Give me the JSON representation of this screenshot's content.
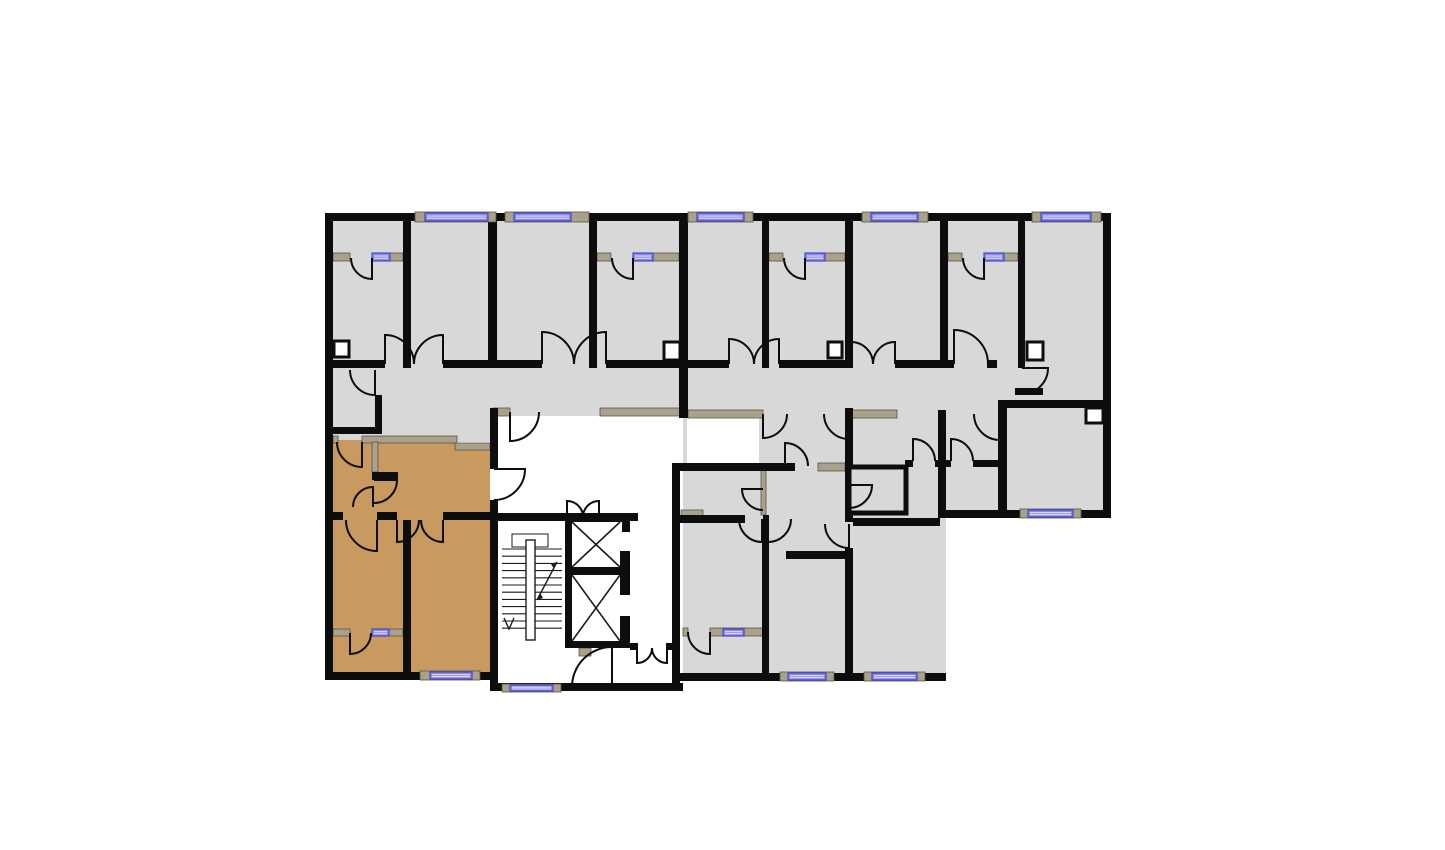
{
  "meta": {
    "type": "floor-plan",
    "canvas": {
      "w": 1445,
      "h": 850
    }
  },
  "palette": {
    "background": "#ffffff",
    "room_gray": "#d8d8d8",
    "highlight_tan": "#c89a60",
    "wall_black": "#0d0d0d",
    "partition_khaki": "#a9a18a",
    "partition_edge": "#57544a",
    "window_blue": "#8a88ee",
    "window_border": "#4547c9",
    "window_stripe": "#d9d9fb",
    "thin_line": "#1c1c1c"
  },
  "floorplan": {
    "gray_fills": [
      [
        333,
        221,
        770,
        147
      ],
      [
        1025,
        360,
        78,
        48
      ],
      [
        333,
        360,
        347,
        56
      ],
      [
        687,
        360,
        253,
        58
      ],
      [
        938,
        368,
        165,
        150
      ],
      [
        333,
        408,
        164,
        34
      ],
      [
        683,
        416,
        263,
        260
      ]
    ],
    "white_patches": [
      [
        687,
        418,
        72,
        45
      ]
    ],
    "highlight_polygon": "333,440 455,440 455,448 490,448 490,672 333,672",
    "khaki_walls": [
      [
        333,
        253,
        17,
        8
      ],
      [
        390,
        253,
        13,
        8
      ],
      [
        597,
        253,
        14,
        8
      ],
      [
        653,
        253,
        26,
        8
      ],
      [
        769,
        253,
        14,
        8
      ],
      [
        825,
        253,
        20,
        8
      ],
      [
        948,
        253,
        14,
        8
      ],
      [
        1004,
        253,
        14,
        8
      ],
      [
        493,
        408,
        17,
        8
      ],
      [
        600,
        408,
        80,
        8
      ],
      [
        688,
        410,
        75,
        8
      ],
      [
        852,
        410,
        45,
        8
      ],
      [
        333,
        436,
        5,
        7
      ],
      [
        362,
        436,
        95,
        7
      ],
      [
        455,
        443,
        35,
        7
      ],
      [
        372,
        442,
        6,
        30
      ],
      [
        333,
        629,
        17,
        7
      ],
      [
        388,
        629,
        15,
        7
      ],
      [
        683,
        628,
        5,
        8
      ],
      [
        710,
        628,
        53,
        8
      ],
      [
        681,
        510,
        22,
        7
      ],
      [
        846,
        470,
        5,
        45
      ],
      [
        818,
        463,
        27,
        8
      ],
      [
        579,
        648,
        12,
        8
      ],
      [
        761,
        470,
        5,
        45
      ]
    ],
    "black_walls": [
      [
        325,
        213,
        786,
        8
      ],
      [
        325,
        213,
        8,
        467
      ],
      [
        1103,
        213,
        8,
        305
      ],
      [
        325,
        672,
        172,
        8
      ],
      [
        490,
        683,
        193,
        8
      ],
      [
        678,
        673,
        268,
        8
      ],
      [
        938,
        510,
        173,
        8
      ],
      [
        403,
        221,
        8,
        147
      ],
      [
        488,
        221,
        9,
        147
      ],
      [
        589,
        221,
        8,
        147
      ],
      [
        679,
        221,
        9,
        197
      ],
      [
        762,
        221,
        7,
        147
      ],
      [
        845,
        221,
        8,
        147
      ],
      [
        940,
        221,
        8,
        147
      ],
      [
        1018,
        221,
        7,
        147
      ],
      [
        333,
        360,
        52,
        8
      ],
      [
        443,
        360,
        99,
        8
      ],
      [
        606,
        360,
        123,
        8
      ],
      [
        779,
        360,
        72,
        8
      ],
      [
        895,
        360,
        59,
        8
      ],
      [
        987,
        360,
        10,
        8
      ],
      [
        375,
        395,
        7,
        39
      ],
      [
        333,
        427,
        44,
        7
      ],
      [
        490,
        408,
        8,
        61
      ],
      [
        490,
        500,
        8,
        191
      ],
      [
        325,
        512,
        18,
        8
      ],
      [
        377,
        512,
        20,
        8
      ],
      [
        443,
        512,
        54,
        8
      ],
      [
        403,
        520,
        8,
        152
      ],
      [
        372,
        472,
        26,
        8
      ],
      [
        498,
        513,
        140,
        8
      ],
      [
        672,
        463,
        8,
        228
      ],
      [
        630,
        643,
        8,
        7
      ],
      [
        666,
        643,
        6,
        7
      ],
      [
        565,
        515,
        7,
        133
      ],
      [
        565,
        515,
        65,
        7
      ],
      [
        570,
        567,
        55,
        8
      ],
      [
        565,
        641,
        65,
        7
      ],
      [
        622,
        515,
        8,
        17
      ],
      [
        620,
        551,
        10,
        44
      ],
      [
        620,
        616,
        10,
        27
      ],
      [
        678,
        463,
        117,
        8
      ],
      [
        678,
        515,
        67,
        8
      ],
      [
        763,
        515,
        6,
        8
      ],
      [
        762,
        523,
        7,
        158
      ],
      [
        845,
        408,
        8,
        114
      ],
      [
        845,
        548,
        8,
        133
      ],
      [
        786,
        551,
        60,
        8
      ],
      [
        853,
        518,
        87,
        8
      ],
      [
        905,
        460,
        8,
        7
      ],
      [
        935,
        460,
        16,
        7
      ],
      [
        973,
        460,
        30,
        7
      ],
      [
        938,
        410,
        8,
        108
      ],
      [
        998,
        400,
        105,
        8
      ],
      [
        998,
        400,
        9,
        118
      ],
      [
        1015,
        388,
        28,
        7
      ]
    ],
    "boxes": [
      {
        "r": [
          334,
          341,
          15,
          16
        ],
        "sw": 3,
        "fill": "white"
      },
      {
        "r": [
          664,
          342,
          16,
          18
        ],
        "sw": 3,
        "fill": "white"
      },
      {
        "r": [
          828,
          342,
          14,
          16
        ],
        "sw": 3,
        "fill": "white"
      },
      {
        "r": [
          1027,
          342,
          16,
          18
        ],
        "sw": 3,
        "fill": "white"
      },
      {
        "r": [
          1086,
          408,
          17,
          15
        ],
        "sw": 3,
        "fill": "white"
      },
      {
        "r": [
          849,
          467,
          57,
          46
        ],
        "sw": 5,
        "fill": "room"
      }
    ],
    "windows": [
      {
        "pad": [
          415,
          212,
          81,
          10
        ],
        "win": [
          425,
          213,
          63,
          8
        ]
      },
      {
        "pad": [
          505,
          212,
          84,
          10
        ],
        "win": [
          514,
          213,
          57,
          8
        ]
      },
      {
        "pad": [
          688,
          212,
          65,
          10
        ],
        "win": [
          697,
          213,
          47,
          8
        ]
      },
      {
        "pad": [
          862,
          212,
          66,
          10
        ],
        "win": [
          871,
          213,
          47,
          8
        ]
      },
      {
        "pad": [
          1032,
          212,
          69,
          10
        ],
        "win": [
          1041,
          213,
          50,
          8
        ]
      },
      {
        "pad": [
          420,
          671,
          60,
          9
        ],
        "win": [
          430,
          672,
          42,
          7
        ]
      },
      {
        "pad": [
          780,
          672,
          54,
          9
        ],
        "win": [
          788,
          673,
          38,
          7
        ]
      },
      {
        "pad": [
          864,
          672,
          61,
          9
        ],
        "win": [
          872,
          673,
          45,
          7
        ]
      },
      {
        "pad": [
          502,
          684,
          59,
          8
        ],
        "win": [
          510,
          685,
          43,
          6
        ]
      },
      {
        "pad": [
          1020,
          509,
          61,
          9
        ],
        "win": [
          1028,
          510,
          45,
          7
        ]
      }
    ],
    "transom_windows": [
      [
        372,
        253,
        18,
        8
      ],
      [
        633,
        253,
        20,
        8
      ],
      [
        805,
        253,
        20,
        8
      ],
      [
        984,
        253,
        20,
        8
      ],
      [
        372,
        629,
        17,
        7
      ],
      [
        723,
        629,
        21,
        7
      ]
    ],
    "doors": [
      {
        "h": [
          372,
          258
        ],
        "r": 21,
        "leaf": 90,
        "wall": 180,
        "sweep": 1
      },
      {
        "h": [
          633,
          258
        ],
        "r": 21,
        "leaf": 90,
        "wall": 180,
        "sweep": 1
      },
      {
        "h": [
          805,
          258
        ],
        "r": 21,
        "leaf": 90,
        "wall": 180,
        "sweep": 1
      },
      {
        "h": [
          984,
          258
        ],
        "r": 21,
        "leaf": 90,
        "wall": 180,
        "sweep": 1
      },
      {
        "h": [
          385,
          364
        ],
        "r": 29,
        "leaf": 270,
        "wall": 0,
        "sweep": 1
      },
      {
        "h": [
          443,
          364
        ],
        "r": 29,
        "leaf": 270,
        "wall": 180,
        "sweep": 0
      },
      {
        "h": [
          542,
          364
        ],
        "r": 32,
        "leaf": 270,
        "wall": 0,
        "sweep": 1
      },
      {
        "h": [
          606,
          364
        ],
        "r": 32,
        "leaf": 270,
        "wall": 180,
        "sweep": 0
      },
      {
        "h": [
          729,
          364
        ],
        "r": 25,
        "leaf": 270,
        "wall": 0,
        "sweep": 1
      },
      {
        "h": [
          779,
          364
        ],
        "r": 25,
        "leaf": 270,
        "wall": 180,
        "sweep": 0
      },
      {
        "h": [
          851,
          364
        ],
        "r": 22,
        "leaf": 270,
        "wall": 0,
        "sweep": 1
      },
      {
        "h": [
          895,
          364
        ],
        "r": 22,
        "leaf": 270,
        "wall": 180,
        "sweep": 0
      },
      {
        "h": [
          954,
          364
        ],
        "r": 34,
        "leaf": 270,
        "wall": 0,
        "sweep": 1
      },
      {
        "h": [
          1022,
          368
        ],
        "r": 26,
        "leaf": 0,
        "wall": 90,
        "sweep": 1
      },
      {
        "h": [
          1000,
          414
        ],
        "r": 26,
        "leaf": 90,
        "wall": 180,
        "sweep": 1
      },
      {
        "h": [
          375,
          370
        ],
        "r": 25,
        "leaf": 90,
        "wall": 180,
        "sweep": 1
      },
      {
        "h": [
          362,
          442
        ],
        "r": 25,
        "leaf": 90,
        "wall": 180,
        "sweep": 1
      },
      {
        "h": [
          494,
          469
        ],
        "r": 31,
        "leaf": 0,
        "wall": 90,
        "sweep": 1
      },
      {
        "h": [
          374,
          480
        ],
        "r": 23,
        "leaf": 0,
        "wall": 90,
        "sweep": 1
      },
      {
        "h": [
          373,
          507
        ],
        "r": 20,
        "leaf": 270,
        "wall": 180,
        "sweep": 0
      },
      {
        "h": [
          377,
          520
        ],
        "r": 31,
        "leaf": 90,
        "wall": 180,
        "sweep": 1
      },
      {
        "h": [
          397,
          520
        ],
        "r": 22,
        "leaf": 90,
        "wall": 0,
        "sweep": 0
      },
      {
        "h": [
          443,
          520
        ],
        "r": 22,
        "leaf": 90,
        "wall": 180,
        "sweep": 1
      },
      {
        "h": [
          350,
          633
        ],
        "r": 21,
        "leaf": 90,
        "wall": 0,
        "sweep": 0
      },
      {
        "h": [
          510,
          412
        ],
        "r": 29,
        "leaf": 90,
        "wall": 0,
        "sweep": 0
      },
      {
        "h": [
          567,
          517
        ],
        "r": 16,
        "leaf": 270,
        "wall": 0,
        "sweep": 1
      },
      {
        "h": [
          599,
          517
        ],
        "r": 16,
        "leaf": 270,
        "wall": 180,
        "sweep": 0
      },
      {
        "h": [
          637,
          648
        ],
        "r": 15,
        "leaf": 90,
        "wall": 0,
        "sweep": 0
      },
      {
        "h": [
          667,
          648
        ],
        "r": 15,
        "leaf": 90,
        "wall": 180,
        "sweep": 1
      },
      {
        "h": [
          612,
          687
        ],
        "r": 40,
        "leaf": 270,
        "wall": 180,
        "sweep": 0
      },
      {
        "h": [
          763,
          414
        ],
        "r": 24,
        "leaf": 90,
        "wall": 0,
        "sweep": 0
      },
      {
        "h": [
          849,
          414
        ],
        "r": 25,
        "leaf": 90,
        "wall": 180,
        "sweep": 1
      },
      {
        "h": [
          785,
          466
        ],
        "r": 23,
        "leaf": 270,
        "wall": 0,
        "sweep": 1
      },
      {
        "h": [
          763,
          489
        ],
        "r": 21,
        "leaf": 180,
        "wall": 90,
        "sweep": 0
      },
      {
        "h": [
          762,
          519
        ],
        "r": 23,
        "leaf": 90,
        "wall": 180,
        "sweep": 1
      },
      {
        "h": [
          768,
          519
        ],
        "r": 23,
        "leaf": 90,
        "wall": 0,
        "sweep": 0
      },
      {
        "h": [
          849,
          524
        ],
        "r": 24,
        "leaf": 90,
        "wall": 180,
        "sweep": 1
      },
      {
        "h": [
          913,
          461
        ],
        "r": 22,
        "leaf": 270,
        "wall": 0,
        "sweep": 1
      },
      {
        "h": [
          951,
          461
        ],
        "r": 22,
        "leaf": 270,
        "wall": 0,
        "sweep": 1
      },
      {
        "h": [
          710,
          632
        ],
        "r": 22,
        "leaf": 90,
        "wall": 180,
        "sweep": 1
      },
      {
        "h": [
          849,
          485
        ],
        "r": 23,
        "leaf": 0,
        "wall": 90,
        "sweep": 1
      }
    ],
    "elevators": [
      {
        "inner": [
          572,
          522,
          620,
          567
        ]
      },
      {
        "inner": [
          572,
          575,
          620,
          641
        ]
      }
    ],
    "stairs": {
      "treads": {
        "x1": 502,
        "x2": 562,
        "y_start": 549,
        "step": 7.2,
        "count": 12
      },
      "stringer": [
        526,
        540,
        9,
        100
      ],
      "guide": [
        512,
        534,
        36,
        13
      ],
      "diag_arrow": [
        557,
        562,
        537,
        600
      ],
      "down_arrow": "504,618 509,629 514,618"
    }
  }
}
